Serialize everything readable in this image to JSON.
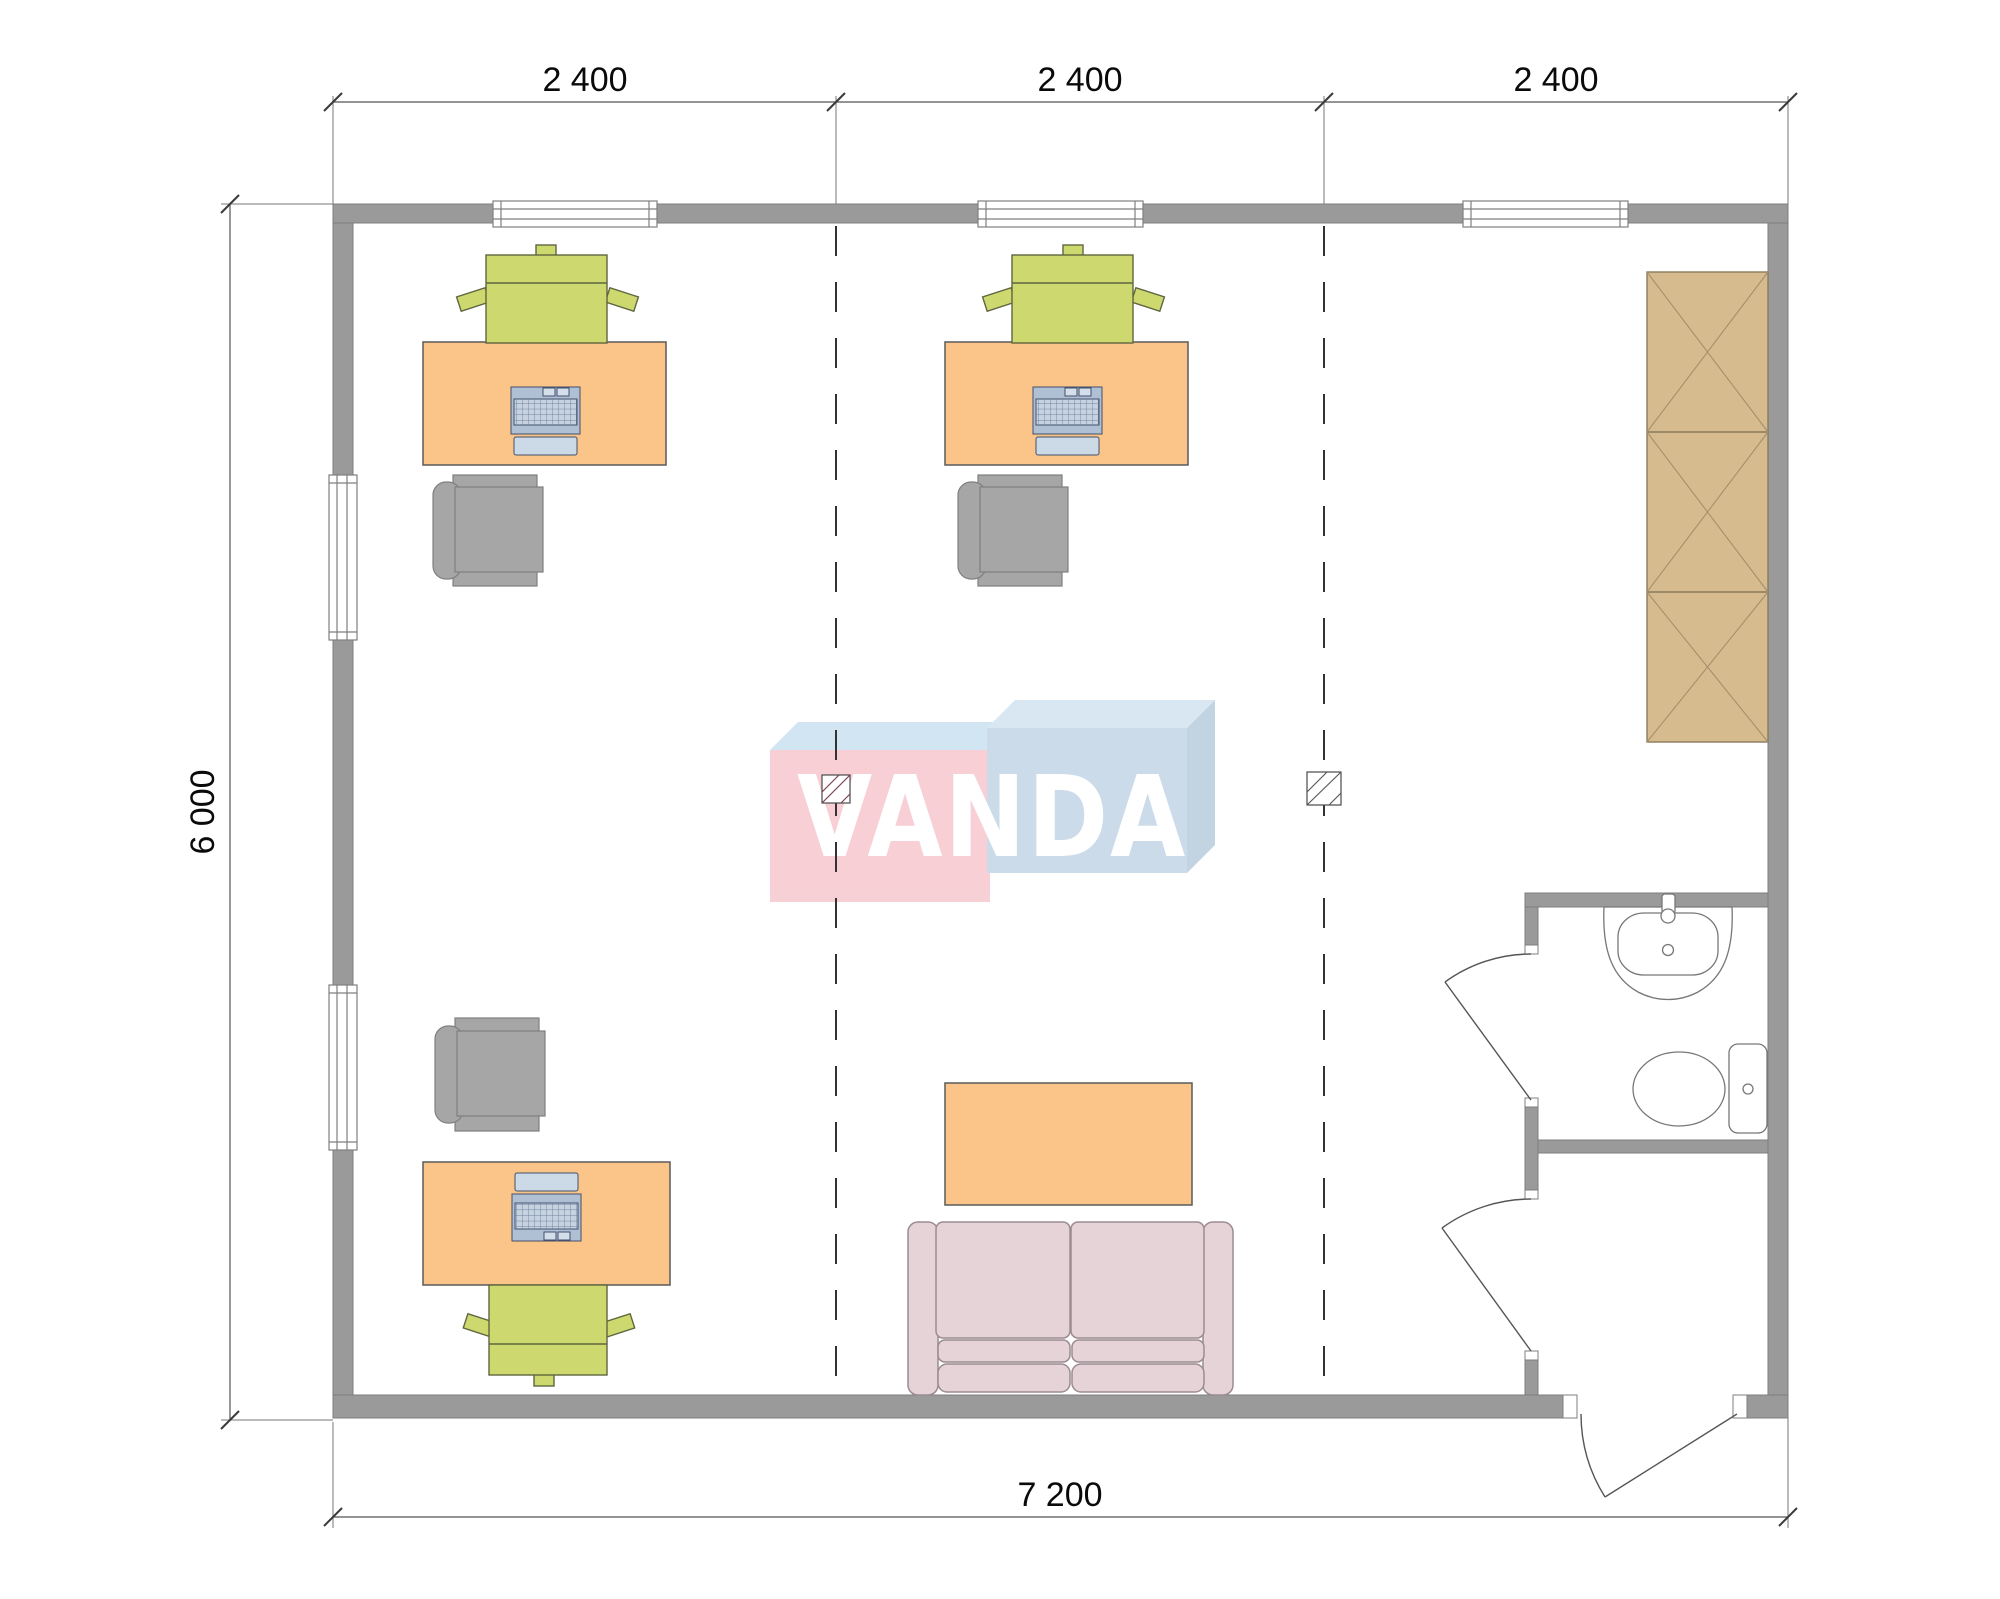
{
  "document": {
    "type": "architectural-floor-plan",
    "units": "mm"
  },
  "dimensions": {
    "top": [
      {
        "label": "2 400"
      },
      {
        "label": "2 400"
      },
      {
        "label": "2 400"
      }
    ],
    "left": {
      "label": "6 000"
    },
    "bottom": {
      "label": "7 200"
    }
  },
  "watermark": {
    "text": "VANDA"
  },
  "colors": {
    "background": "#ffffff",
    "wall": "#9a9a9a",
    "wall_edge": "#7d7d7d",
    "desk": "#fbc488",
    "desk_edge": "#5a5a5a",
    "task_chair": "#cdd96e",
    "task_chair_edge": "#5f6640",
    "visitor_chair": "#a6a6a6",
    "visitor_chair_edge": "#7f7f7f",
    "cabinet": "#d6bb8f",
    "cabinet_edge": "#8a7a5c",
    "cabinet_cross": "#a5906a",
    "sofa": "#e5d3d7",
    "sofa_edge": "#9c8b90",
    "table": "#fbc488",
    "laptop_deck": "#b0c0d4",
    "laptop_key": "#c6d2e0",
    "laptop_lid": "#ccdae8",
    "laptop_edge": "#42506b",
    "fixture_line": "#777777",
    "door_line": "#555555",
    "dim_line": "#555555",
    "grid_dash": "#333333",
    "logo_pink": "#f7cdd3",
    "logo_blue": "#c9dae8",
    "logo_top_left": "#cfe4f2",
    "logo_top_right": "#d7e6f3",
    "logo_side_right": "#bfd1e1"
  },
  "inventory": {
    "desks": 3,
    "laptops": 3,
    "task_chairs": 3,
    "visitor_chairs": 3,
    "sofa": 1,
    "coffee_table": 1,
    "wardrobe_sections": 3,
    "sink": 1,
    "toilet": 1,
    "windows_top": 3,
    "windows_left": 2,
    "interior_doors": 2,
    "entrance_doors": 1,
    "columns": 2
  }
}
